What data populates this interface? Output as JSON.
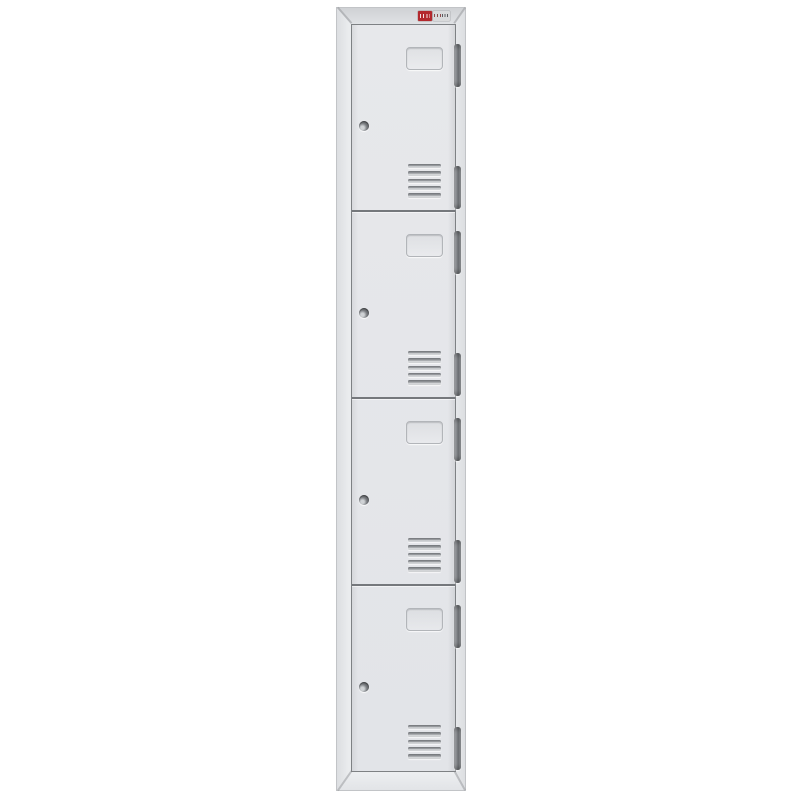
{
  "product": {
    "type": "four-tier storage locker, front product photo",
    "door_count": 4,
    "doors": [
      {
        "id": "door-1",
        "label": "Door 1",
        "parts": [
          "recessed-handle",
          "cam-lock",
          "louver-vents",
          "hinge-top",
          "hinge-bottom"
        ]
      },
      {
        "id": "door-2",
        "label": "Door 2",
        "parts": [
          "recessed-handle",
          "cam-lock",
          "louver-vents",
          "hinge-top",
          "hinge-bottom"
        ]
      },
      {
        "id": "door-3",
        "label": "Door 3",
        "parts": [
          "recessed-handle",
          "cam-lock",
          "louver-vents",
          "hinge-top",
          "hinge-bottom"
        ]
      },
      {
        "id": "door-4",
        "label": "Door 4",
        "parts": [
          "recessed-handle",
          "cam-lock",
          "louver-vents",
          "hinge-top",
          "hinge-bottom"
        ]
      }
    ],
    "vent_slats_per_door": 5,
    "brand_label": {
      "text_legible": false,
      "bar_color": "#b3282d",
      "panel_color": "#d9dadb"
    }
  },
  "colors": {
    "page-bg": "#ffffff",
    "frame-face": "#eaecee",
    "frame-edge": "#c2c4c7",
    "frame-edge-shade": "#dcdee1",
    "bevel-top-from": "#cfd1d4",
    "bevel-top-to": "#e0e2e5",
    "bevel-bottom-from": "#eef0f2",
    "bevel-bottom-to": "#e2e4e7",
    "door-face-from": "#e7e8eb",
    "door-face-to": "#e2e4e8",
    "door-border": "#7e8184",
    "seam": "#75787c",
    "handle-line": "#b2b5b9",
    "lock-light": "#cfd2d5",
    "lock-mid": "#7d8084",
    "lock-dark": "#54575b",
    "vent-dark": "#6f7276",
    "vent-mid": "#989b9f",
    "vent-light": "#dcdee0",
    "hinge-light": "#babcbf",
    "hinge-mid": "#8d9094",
    "hinge-dark": "#6a6d71",
    "label-red": "#b3282d",
    "label-panel": "#d9dadb"
  }
}
